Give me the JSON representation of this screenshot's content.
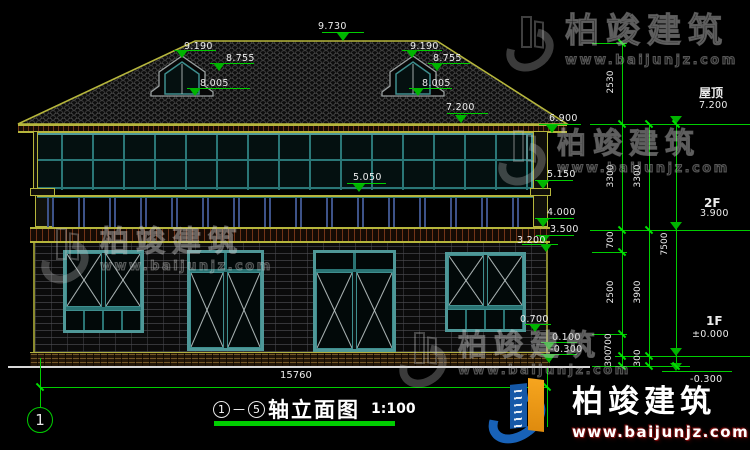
{
  "watermark": {
    "brand": "柏竣建筑",
    "site": "www.baijunjz.com"
  },
  "title": {
    "axis_from": "1",
    "dash": "—",
    "axis_to": "5",
    "name": "轴立面图",
    "scale": "1:100"
  },
  "axis_bubble": "1",
  "colors": {
    "dim_green": "#00ce00",
    "outline_yellow": "#b6b63c",
    "frame_teal": "#4f9898",
    "text_white": "#ececec",
    "logo_blue": "#1862b8",
    "logo_orange": "#f6a51e"
  },
  "elevation_markers": [
    {
      "t": "9.730",
      "lx": 318,
      "ly": 21,
      "x1": 322,
      "x2": 364,
      "my": 32,
      "ax": 343,
      "ay": 41
    },
    {
      "t": "9.190",
      "lx": 184,
      "ly": 41,
      "x1": 174,
      "x2": 216,
      "my": 50,
      "ax": 182,
      "ay": 58
    },
    {
      "t": "8.755",
      "lx": 226,
      "ly": 53,
      "x1": 210,
      "x2": 254,
      "my": 63,
      "ax": 219,
      "ay": 71
    },
    {
      "t": "8.005",
      "lx": 200,
      "ly": 78,
      "x1": 187,
      "x2": 250,
      "my": 88,
      "ax": 195,
      "ay": 96
    },
    {
      "t": "9.190",
      "lx": 410,
      "ly": 41,
      "x1": 402,
      "x2": 442,
      "my": 50,
      "ax": 412,
      "ay": 58
    },
    {
      "t": "8.755",
      "lx": 433,
      "ly": 53,
      "x1": 428,
      "x2": 470,
      "my": 63,
      "ax": 437,
      "ay": 71
    },
    {
      "t": "8.005",
      "lx": 422,
      "ly": 78,
      "x1": 409,
      "x2": 452,
      "my": 88,
      "ax": 418,
      "ay": 96
    },
    {
      "t": "7.200",
      "lx": 446,
      "ly": 102,
      "x1": 447,
      "x2": 488,
      "my": 113,
      "ax": 461,
      "ay": 123
    },
    {
      "t": "6.900",
      "lx": 549,
      "ly": 113,
      "x1": 539,
      "x2": 581,
      "my": 124,
      "ax": 552,
      "ay": 133
    },
    {
      "t": "5.150",
      "lx": 547,
      "ly": 169,
      "x1": 535,
      "x2": 573,
      "my": 180,
      "ax": 543,
      "ay": 189
    },
    {
      "t": "5.050",
      "lx": 353,
      "ly": 172,
      "x1": 347,
      "x2": 386,
      "my": 183,
      "ax": 359,
      "ay": 192
    },
    {
      "t": "4.000",
      "lx": 547,
      "ly": 207,
      "x1": 535,
      "x2": 574,
      "my": 218,
      "ax": 543,
      "ay": 227
    },
    {
      "t": "3.500",
      "lx": 550,
      "ly": 224,
      "x1": 536,
      "x2": 574,
      "my": 235,
      "ax": 544,
      "ay": 243
    },
    {
      "t": "3.200",
      "lx": 517,
      "ly": 235,
      "x1": 522,
      "x2": 558,
      "my": 244,
      "ax": 546,
      "ay": 252
    },
    {
      "t": "0.700",
      "lx": 520,
      "ly": 314,
      "x1": 525,
      "x2": 551,
      "my": 324,
      "ax": 535,
      "ay": 332
    },
    {
      "t": "0.100",
      "lx": 552,
      "ly": 332,
      "x1": 541,
      "x2": 577,
      "my": 342,
      "ax": 549,
      "ay": 350
    },
    {
      "t": "-0.300",
      "lx": 550,
      "ly": 344,
      "x1": 541,
      "x2": 577,
      "my": 354,
      "ax": 549,
      "ay": 363
    },
    {
      "t": "7.200",
      "lx": 699,
      "ly": 100,
      "x1": 650,
      "x2": 748,
      "my": 124,
      "ax": 676,
      "ay": 124
    },
    {
      "t": "3.900",
      "lx": 700,
      "ly": 208,
      "x1": 650,
      "x2": 748,
      "my": 230,
      "ax": 676,
      "ay": 230
    },
    {
      "t": "±0.000",
      "lx": 692,
      "ly": 329,
      "x1": 655,
      "x2": 748,
      "my": 356,
      "ax": 676,
      "ay": 356
    },
    {
      "t": "-0.300",
      "lx": 690,
      "ly": 374,
      "x1": 662,
      "x2": 732,
      "my": 371,
      "ax": 676,
      "ay": 371
    }
  ],
  "vertical_dims": [
    {
      "t": "2530",
      "x": 612,
      "y": 83
    },
    {
      "t": "3300",
      "x": 612,
      "y": 177
    },
    {
      "t": "700",
      "x": 612,
      "y": 241
    },
    {
      "t": "2500",
      "x": 612,
      "y": 293
    },
    {
      "t": "700",
      "x": 610,
      "y": 343
    },
    {
      "t": "300",
      "x": 610,
      "y": 359
    },
    {
      "t": "3300",
      "x": 639,
      "y": 177
    },
    {
      "t": "3900",
      "x": 639,
      "y": 293
    },
    {
      "t": "300",
      "x": 639,
      "y": 359
    },
    {
      "t": "7500",
      "x": 666,
      "y": 245
    }
  ],
  "texts": [
    {
      "t": "屋顶",
      "x": 699,
      "y": 84,
      "s": 12,
      "b": 1,
      "n": "floor-label-roof"
    },
    {
      "t": "2F",
      "x": 704,
      "y": 196,
      "s": 12,
      "b": 1,
      "n": "floor-label-2f"
    },
    {
      "t": "1F",
      "x": 706,
      "y": 314,
      "s": 12,
      "b": 1,
      "n": "floor-label-1f"
    },
    {
      "t": "15760",
      "x": 280,
      "y": 370,
      "s": 10,
      "b": 0,
      "n": "overall-width-dimension"
    }
  ],
  "green_lines": [
    {
      "x": 592,
      "y": 43,
      "w": 35,
      "h": 1
    },
    {
      "x": 590,
      "y": 124,
      "w": 160,
      "h": 1
    },
    {
      "x": 590,
      "y": 230,
      "w": 160,
      "h": 1
    },
    {
      "x": 592,
      "y": 252,
      "w": 35,
      "h": 1
    },
    {
      "x": 592,
      "y": 334,
      "w": 35,
      "h": 1
    },
    {
      "x": 615,
      "y": 356,
      "w": 135,
      "h": 1
    },
    {
      "x": 592,
      "y": 366,
      "w": 98,
      "h": 1
    },
    {
      "x": 40,
      "y": 387,
      "w": 507,
      "h": 1
    },
    {
      "x": 622,
      "y": 43,
      "w": 1,
      "h": 323
    },
    {
      "x": 649,
      "y": 124,
      "w": 1,
      "h": 242
    },
    {
      "x": 676,
      "y": 124,
      "w": 1,
      "h": 242
    },
    {
      "x": 547,
      "y": 368,
      "w": 1,
      "h": 59
    },
    {
      "x": 40,
      "y": 358,
      "w": 1,
      "h": 49
    }
  ],
  "ticks": [
    {
      "x": 622,
      "y": 43
    },
    {
      "x": 622,
      "y": 124
    },
    {
      "x": 622,
      "y": 230
    },
    {
      "x": 622,
      "y": 252
    },
    {
      "x": 622,
      "y": 334
    },
    {
      "x": 622,
      "y": 356
    },
    {
      "x": 622,
      "y": 366
    },
    {
      "x": 649,
      "y": 124
    },
    {
      "x": 649,
      "y": 230
    },
    {
      "x": 649,
      "y": 356
    },
    {
      "x": 649,
      "y": 366
    },
    {
      "x": 676,
      "y": 124
    },
    {
      "x": 676,
      "y": 366
    },
    {
      "x": 40,
      "y": 387
    },
    {
      "x": 547,
      "y": 387
    }
  ]
}
